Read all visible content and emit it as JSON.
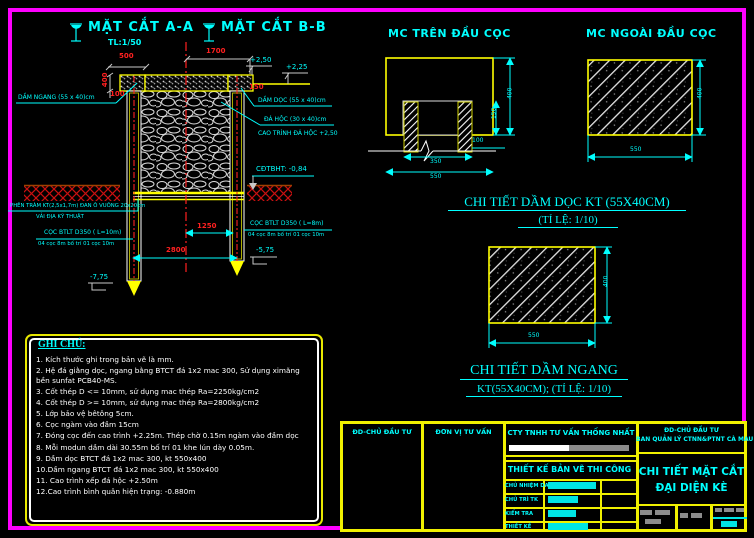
{
  "colors": {
    "background": "#000000",
    "frame": "#ff00ff",
    "line_yellow": "#ffff00",
    "text_cyan": "#00ffff",
    "dim_red": "#ff2020",
    "white": "#ffffff",
    "redact_gray": "#8c8c8c"
  },
  "titles": {
    "aa": "MẶT CẮT A-A",
    "aa_scale": "TL:1/50",
    "bb": "MẶT CẮT B-B",
    "mc_tren": "MC TRÊN ĐẦU CỌC",
    "mc_ngoai": "MC NGOÀI ĐẦU CỌC",
    "ct_doc": "CHI TIẾT DẦM DỌC KT (55X40CM)",
    "ct_doc_scale": "(TỈ LỆ: 1/10)",
    "ct_ngang": "CHI TIẾT DẦM NGANG",
    "ct_ngang_scale": "KT(55X40CM); (TỈ LỆ: 1/10)"
  },
  "main": {
    "d500": "500",
    "d1700": "1700",
    "d400": "400",
    "d100": "100",
    "d150": "150",
    "d1250": "1250",
    "d2800": "2800",
    "e250": "+2,50",
    "e225": "+2,25",
    "e575": "-5,75",
    "e775": "-7,75",
    "cdtbht": "CĐTBHT: -0,84",
    "dam_ngang": "DẦM NGANG (55 x 40)cm",
    "dam_doc": "DẦM DỌC (55 x 40)cm",
    "da_hoc": "ĐÁ HỘC (30 x 40)cm",
    "cao_trinh": "CAO TRÌNH ĐÁ HỘC +2,50",
    "phen_tram": "PHÊN TRÀM KT(2,5x1,7m) ĐAN Ô VUÔNG 20x20cm",
    "vai_dia": "VẢI ĐỊA KỸ THUẬT",
    "coc_left": "CỌC BTLT D350 ( L=10m)",
    "coc_left_sub": "04 cọc 8m bố trí 01 cọc 10m",
    "coc_right": "CỌC BTLT D350 ( L=8m)",
    "coc_right_sub": "04 cọc 8m bố trí 01 cọc 10m"
  },
  "mc_tren": {
    "d400": "400",
    "d150": "150",
    "d100": "100",
    "d350": "350",
    "d550": "550"
  },
  "mc_ngoai": {
    "d400": "400",
    "d550": "550"
  },
  "ct_doc": {
    "d400": "400",
    "d550": "550"
  },
  "notes": {
    "title": "GHI CHÚ:",
    "items": [
      "1. Kích thước ghi trong bản vẽ là mm.",
      "2. Hệ đá giằng dọc, ngang bằng BTCT đá 1x2 mac 300, Sử dụng ximăng bền sunfat PCB40-MS.",
      "3. Cốt thép D <= 10mm, sử dụng mac thép Ra=2250kg/cm2",
      "4. Cốt thép D >= 10mm, sử dụng mac thép Ra=2800kg/cm2",
      "5. Lớp bảo vệ bêtông 5cm.",
      "6. Cọc ngàm vào đầm 15cm",
      "7. Đóng cọc đến cao trình +2.25m. Thép chờ 0.15m ngàm vào đầm dọc",
      "8. Mỗi modun dầm dài 30.55m bố trí 01 khe lún dày 0.05m.",
      "9. Dầm dọc BTCT đá 1x2 mac 300, kt 550x400",
      "10.Dầm ngang BTCT đá 1x2 mac 300, kt 550x400",
      "11. Cao trình xếp đá hộc +2.50m",
      "12.Cao trình bình quân hiện trạng: -0.880m"
    ]
  },
  "tb": {
    "col1": "ĐD-CHỦ ĐẦU TƯ",
    "col2": "ĐƠN VỊ TƯ VẤN",
    "company": "CTY TNHH TƯ VẤN THỐNG NHẤT",
    "stage": "THIẾT KẾ BẢN VẼ THI CÔNG",
    "rows": [
      {
        "label": "CHỦ NHIỆM DA"
      },
      {
        "label": "CHỦ TRÌ TK"
      },
      {
        "label": "KIỂM TRA"
      },
      {
        "label": "THIẾT KẾ"
      }
    ],
    "owner1": "ĐD-CHỦ ĐẦU TƯ",
    "owner2": "BAN QUẢN LÝ CTNN&PTNT CÀ MAU",
    "title1": "CHI TIẾT MẶT CẮT",
    "title2": "ĐẠI DIỆN KÈ"
  }
}
